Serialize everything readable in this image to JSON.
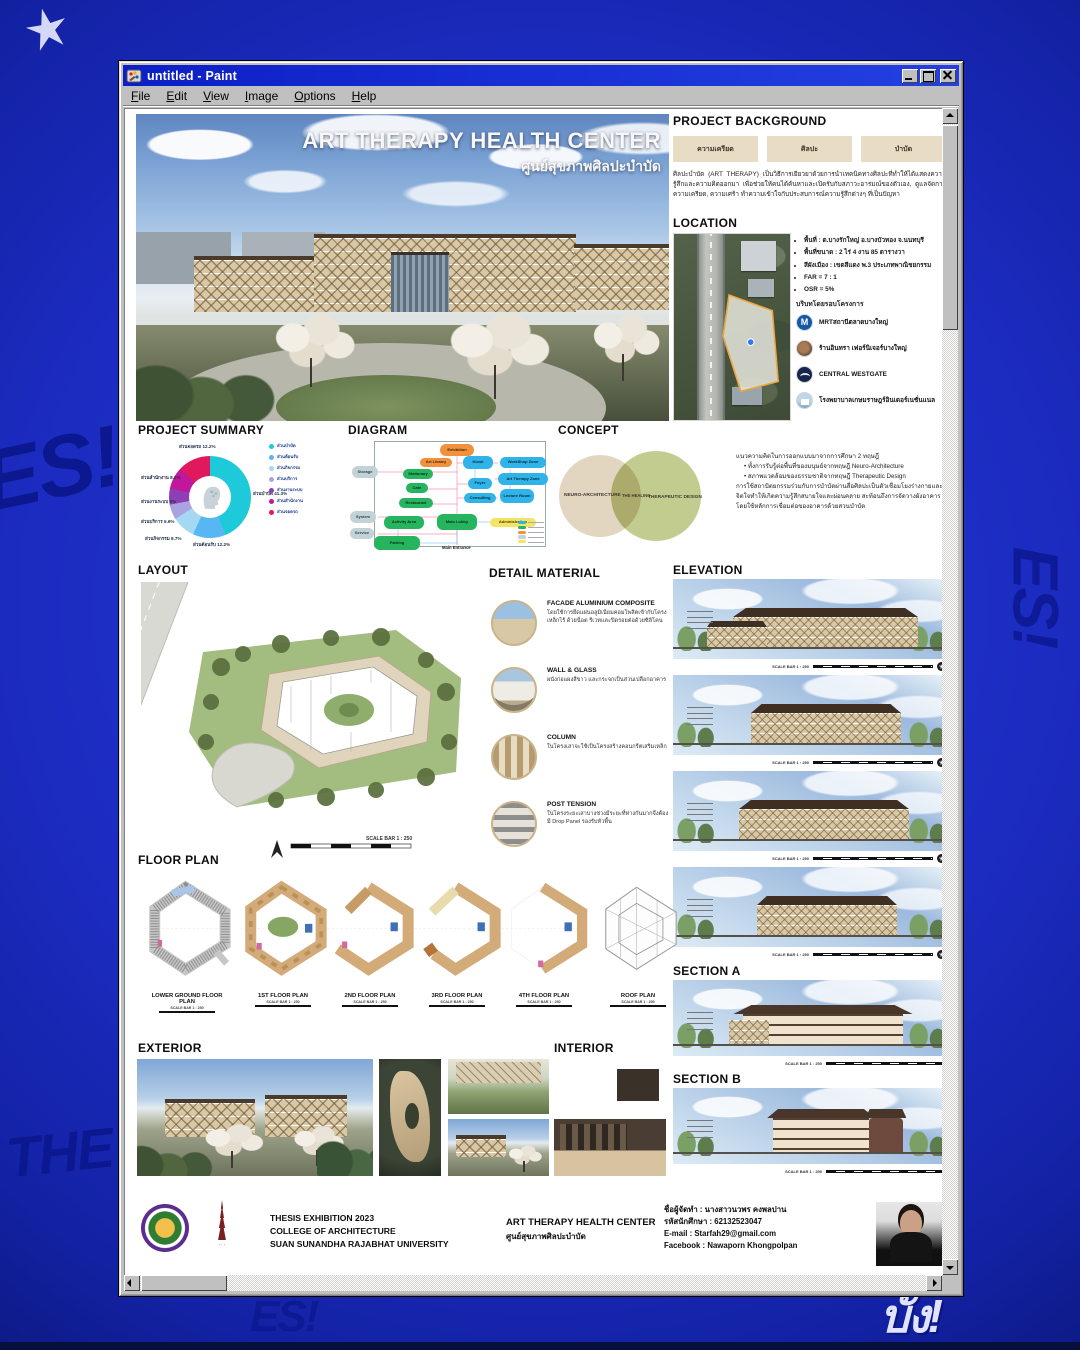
{
  "window": {
    "title": "untitled - Paint",
    "menu": [
      "File",
      "Edit",
      "View",
      "Image",
      "Options",
      "Help"
    ]
  },
  "desktop": {
    "bg_color": "#1c2cc1",
    "graffiti": [
      "ES!",
      "THE",
      "บั้ง!",
      "ES!"
    ]
  },
  "poster": {
    "scale_label": "SCALE BAR 1 : 250",
    "hero": {
      "title": "ART THERAPY HEALTH CENTER",
      "subtitle": "ศูนย์สุขภาพศิลปะบำบัด"
    },
    "project_background": {
      "heading": "PROJECT BACKGROUND",
      "buttons": [
        "ความเครียด",
        "ศิลปะ",
        "บำบัด"
      ],
      "body": "ศิลปะบำบัด (ART THERAPY) เป็นวิธีการเยียวยาด้วยการนำเทคนิคทางศิลปะที่ทำให้ได้แสดงความรู้สึกและความคิดออกมา เพื่อช่วยให้คนได้ค้นหาและเปิดรับกับสภาวะอารมณ์ของตัวเอง, ดูแลจัดการความเครียด, ความเศร้า ทำความเข้าใจกับประสบการณ์ความรู้สึกต่างๆ ที่เป็นปัญหา"
    },
    "location": {
      "heading": "LOCATION",
      "bullets": [
        "พื้นที่ : ต.บางรักใหญ่ อ.บางบัวทอง จ.นนทบุรี",
        "พื้นที่ขนาด : 2 ไร่ 4 งาน 85 ตารางวา",
        "สีผังเมือง : เขตสีแดง พ.3 ประเภทพาณิชยกรรม",
        "FAR = 7 : 1",
        "OSR = 5%"
      ],
      "context_heading": "บริบทโดยรอบโครงการ",
      "context": [
        {
          "icon": "mrt-icon",
          "icon_letter": "M",
          "label": "MRTสถานีตลาดบางใหญ่"
        },
        {
          "icon": "furniture-store-icon",
          "label": "ร้านอินทรา เฟอร์นิเจอร์บางใหญ่"
        },
        {
          "icon": "mall-icon",
          "label": "CENTRAL WESTGATE"
        },
        {
          "icon": "hospital-icon",
          "label": "โรงพยาบาลเกษมราษฎร์อินเตอร์เนชั่นแนล"
        }
      ]
    },
    "project_summary": {
      "heading": "PROJECT SUMMARY",
      "segments": [
        {
          "label": "ส่วนบำบัด",
          "pct": "41.3%",
          "color": "#1ec9d9"
        },
        {
          "label": "ส่วนต้อนรับ",
          "pct": "12.2%",
          "color": "#56b7f2"
        },
        {
          "label": "ส่วนกิจกรรม",
          "pct": "8.7%",
          "color": "#a5d8f3"
        },
        {
          "label": "ส่วนบริการ",
          "pct": "5.6%",
          "color": "#a9a3e0"
        },
        {
          "label": "ส่วนงานระบบ",
          "pct": "6%",
          "color": "#8f3fb5"
        },
        {
          "label": "ส่วนสำนักงาน",
          "pct": "8.2%",
          "color": "#c0179c"
        },
        {
          "label": "ส่วนจอดรถ",
          "pct": "12.2%",
          "color": "#e0195f"
        }
      ]
    },
    "diagram": {
      "heading": "DIAGRAM",
      "entrance_label": "Main Entrance",
      "legend_colors": [
        "#2fb3e8",
        "#27b45e",
        "#f2913d",
        "#c3d2d6",
        "#f5e463"
      ],
      "nodes": [
        {
          "label": "Storage",
          "type": "gray"
        },
        {
          "label": "System",
          "type": "gray"
        },
        {
          "label": "Service",
          "type": "gray"
        },
        {
          "label": "Exhibition",
          "type": "orange"
        },
        {
          "label": "Art Library",
          "type": "orange"
        },
        {
          "label": "Stationary",
          "type": "green"
        },
        {
          "label": "Cafe",
          "type": "green"
        },
        {
          "label": "Restaurant",
          "type": "green"
        },
        {
          "label": "Activity Area",
          "type": "green"
        },
        {
          "label": "Main Lobby",
          "type": "green"
        },
        {
          "label": "Parking",
          "type": "green"
        },
        {
          "label": "Kiosk",
          "type": "blue"
        },
        {
          "label": "Foyer",
          "type": "blue"
        },
        {
          "label": "Consulting",
          "type": "blue"
        },
        {
          "label": "WorkShop Zone",
          "type": "blue"
        },
        {
          "label": "Art Therapy Zone",
          "type": "blue"
        },
        {
          "label": "Lecture Room",
          "type": "blue"
        },
        {
          "label": "Administration",
          "type": "yellow"
        }
      ]
    },
    "concept": {
      "heading": "CONCEPT",
      "venn": [
        "NEURO-ARCHITECTURE",
        "THE HEALING",
        "THERAPEUTIC DESIGN"
      ],
      "intro": "แนวความคิดในการออกแบบมาจากการศึกษา 2 ทฤษฎี",
      "bullet1": "• ทั้งการรับรู้ต่อพื้นที่ของมนุษย์จากทฤษฎี Neuro-Architecture",
      "bullet2": "• สภาพแวดล้อมของธรรมชาติจากทฤษฎี Therapeutic Design",
      "body": "การใช้สถาปัตยกรรมร่วมกับการบำบัดผ่านสื่อศิลปะเป็นตัวเชื่อมโยงร่างกายและจิตใจทำให้เกิดความรู้สึกสบายใจและผ่อนคลาย สะท้อนถึงการจัดวางผังอาคารโดยใช้หลักการเชื่อมต่อของอาคารด้วยสวนบำบัด"
    },
    "layout": {
      "heading": "LAYOUT",
      "road_label": "ถนนกาญจนาภิเษก",
      "north_label": "N"
    },
    "detail_material": {
      "heading": "DETAIL MATERIAL",
      "items": [
        {
          "title": "FACADE ALUMINIUM COMPOSITE",
          "text": "โดยใช้การยึดแผ่นอลูมิเนียมคอมโพสิตเข้ากับโครงเหล็กไร้ ด้วยน็อต รีเวทและปิดรอยต่อด้วยซิลิโคน"
        },
        {
          "title": "WALL & GLASS",
          "text": "ผนังก่อแผงสีขาว และกระจกเป็นส่วนเปลือกอาคาร"
        },
        {
          "title": "COLUMN",
          "text": "ในโครงเสาจะใช้เป็นโครงสร้างคอนกรีตเสริมเหล็ก"
        },
        {
          "title": "POST TENSION",
          "text": "ในโครงระยะเสาบางช่วงมีระยะที่ห่างกันมากจึงต้องมี Drop Panel รองรับหัวพื้น"
        }
      ]
    },
    "elevation": {
      "heading": "ELEVATION"
    },
    "sections": {
      "a": "SECTION A",
      "b": "SECTION B"
    },
    "floor_plan": {
      "heading": "FLOOR PLAN",
      "plans": [
        "LOWER GROUND FLOOR PLAN",
        "1ST FLOOR PLAN",
        "2ND FLOOR PLAN",
        "3RD FLOOR PLAN",
        "4TH FLOOR PLAN",
        "ROOF PLAN"
      ]
    },
    "exterior_heading": "EXTERIOR",
    "interior_heading": "INTERIOR",
    "footer": {
      "exhibition_lines": [
        "THESIS EXHIBITION 2023",
        "COLLEGE OF ARCHITECTURE",
        "SUAN SUNANDHA RAJABHAT UNIVERSITY"
      ],
      "project_en": "ART THERAPY HEALTH CENTER",
      "project_th": "ศูนย์สุขภาพศิลปะบำบัด",
      "author_lines": [
        "ชื่อผู้จัดทำ : นางสาวนวพร คงพลปาน",
        "รหัสนักศึกษา : 62132523047",
        "E-mail : Starfah29@gmail.com",
        "Facebook : Nawaporn Khongpolpan"
      ]
    }
  },
  "chart_data": {
    "type": "pie",
    "title": "PROJECT SUMMARY",
    "categories": [
      "ส่วนบำบัด",
      "ส่วนต้อนรับ",
      "ส่วนกิจกรรม",
      "ส่วนบริการ",
      "ส่วนงานระบบ",
      "ส่วนสำนักงาน",
      "ส่วนจอดรถ"
    ],
    "values": [
      41.3,
      12.2,
      8.7,
      5.6,
      6.0,
      8.2,
      12.2
    ],
    "colors": [
      "#1ec9d9",
      "#56b7f2",
      "#a5d8f3",
      "#a9a3e0",
      "#8f3fb5",
      "#c0179c",
      "#e0195f"
    ],
    "legend_position": "right"
  }
}
